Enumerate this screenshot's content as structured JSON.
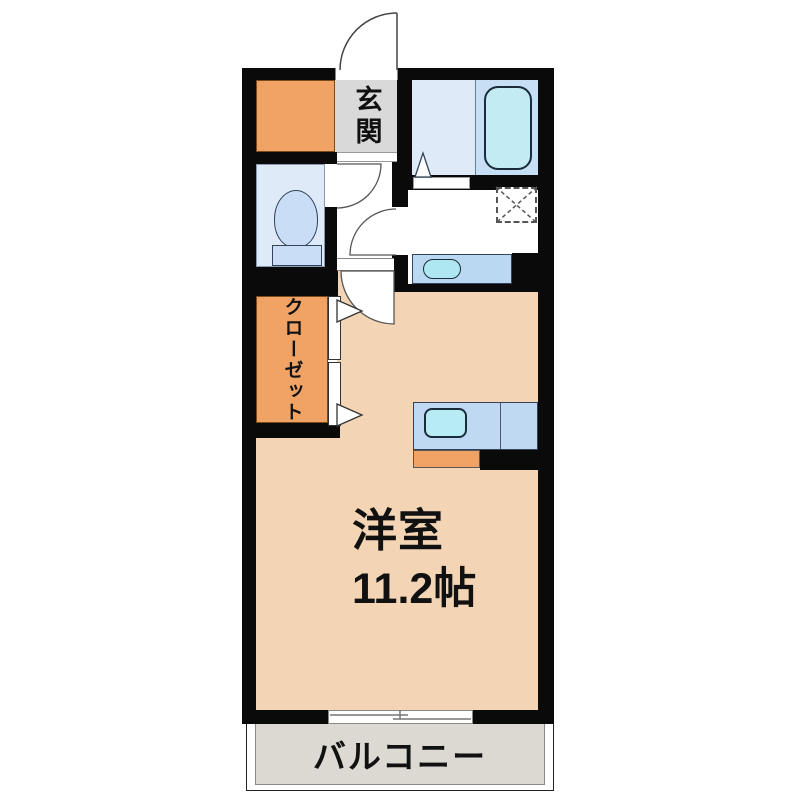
{
  "plan": {
    "type": "japanese-apartment-floorplan",
    "labels": {
      "entrance": "玄関",
      "closet": "クローゼット",
      "main_room": "洋室",
      "main_room_size": "11.2帖",
      "balcony": "バルコニー"
    },
    "fixtures": [
      "bathtub",
      "toilet",
      "washbasin",
      "washing-machine-space",
      "kitchen-sink",
      "stove",
      "closet-folding-doors",
      "entrance-swing-door",
      "toilet-swing-door",
      "washroom-swing-door",
      "main-room-swing-door",
      "bathroom-folding-door",
      "sliding-window-to-balcony"
    ],
    "colors": {
      "wall": "#0a0a0a",
      "main_room_floor": "#F3D5B5",
      "storage_closet_orange": "#F0A365",
      "entrance_floor": "#D9D9D9",
      "wet_area_floor": "#DEEAF8",
      "bathtub_zone": "#C6DFF4",
      "bathtub_fill": "#C2EBF4",
      "counter_blue": "#BAD8F1",
      "sink_cyan": "#AEE6F2",
      "balcony_floor": "#DCD8D2"
    }
  }
}
